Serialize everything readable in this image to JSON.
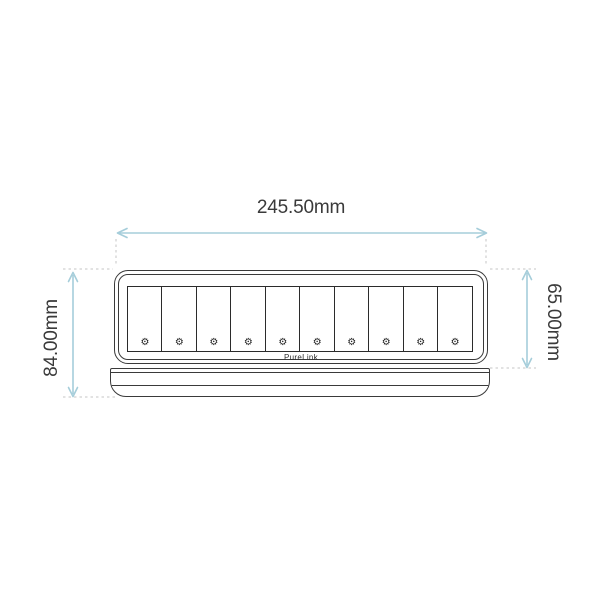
{
  "dimensions": {
    "width_label": "245.50mm",
    "overall_height_label": "84.00mm",
    "body_height_label": "65.00mm"
  },
  "device": {
    "brand": "PureLink",
    "module_count": 10,
    "module_icon": "screw-icon",
    "module_icon_glyph": "⚙"
  },
  "colors": {
    "line": "#3a3a3a",
    "heavy": "#2b2b2b",
    "dimension": "#a5cdda",
    "extension": "#c6c6c6",
    "text": "#3a3a3a",
    "background": "#ffffff"
  }
}
